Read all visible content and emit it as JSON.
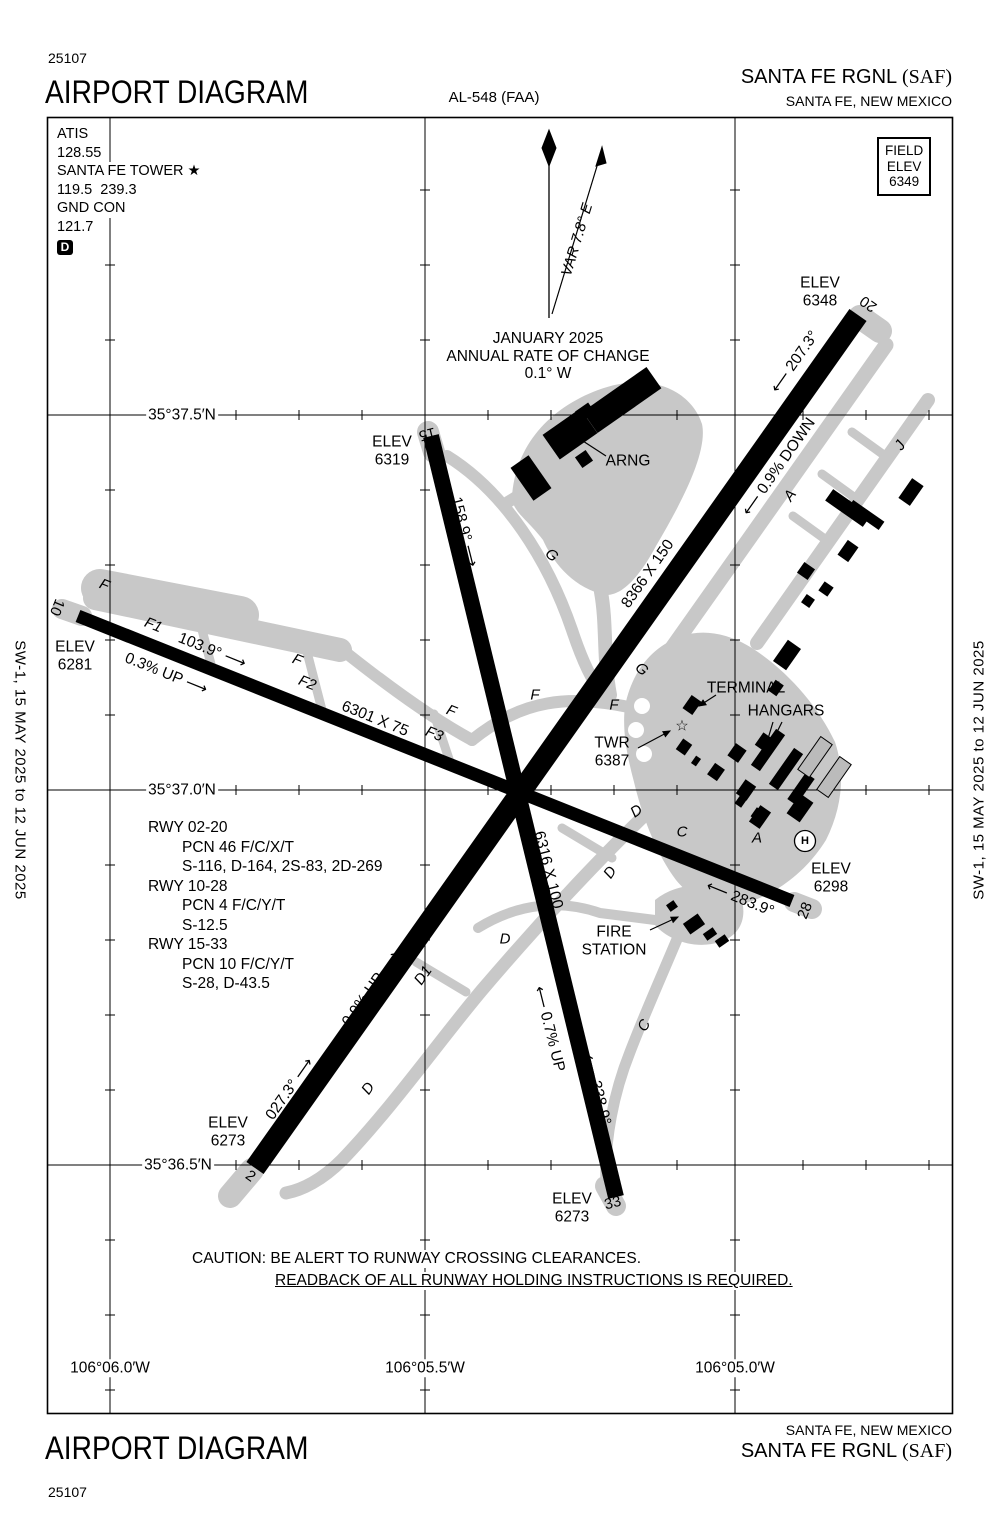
{
  "header": {
    "chart_number": "25107",
    "title": "AIRPORT DIAGRAM",
    "al_number": "AL-548 (FAA)",
    "airport_name": "SANTA FE RGNL ",
    "airport_code": "(SAF)",
    "city": "SANTA FE, NEW MEXICO"
  },
  "footer": {
    "title": "AIRPORT DIAGRAM",
    "chart_number": "25107",
    "city": "SANTA FE, NEW MEXICO",
    "airport_name": "SANTA FE RGNL ",
    "airport_code": "(SAF)"
  },
  "edge_note": "SW-1,  15 MAY 2025  to  12 JUN 2025",
  "comms": {
    "lines": [
      "ATIS",
      "128.55",
      "SANTA FE TOWER ★",
      "119.5  239.3",
      "GND CON",
      "121.7"
    ],
    "delivery_symbol": "D"
  },
  "field_elev": {
    "lines": [
      "FIELD",
      "ELEV",
      "6349"
    ]
  },
  "runways": [
    {
      "id": "02-20",
      "dimensions": "8366 X 150",
      "headings": "027.3° / 207.3°",
      "end_elevs": "6273 / 6348",
      "slope": "0.9%"
    },
    {
      "id": "10-28",
      "dimensions": "6301 X 75",
      "headings": "103.9° / 283.9°",
      "end_elevs": "6281 / 6298",
      "slope": "0.3%"
    },
    {
      "id": "15-33",
      "dimensions": "6316 X 100",
      "headings": "158.9° / 338.9°",
      "end_elevs": "6319 / 6273",
      "slope": "0.7%"
    }
  ],
  "rwy_data": {
    "lines": [
      {
        "t": "RWY 02-20",
        "ind": 0
      },
      {
        "t": "PCN 46 F/C/X/T",
        "ind": 1
      },
      {
        "t": "S-116, D-164, 2S-83, 2D-269",
        "ind": 1
      },
      {
        "t": "RWY 10-28",
        "ind": 0
      },
      {
        "t": "PCN 4 F/C/Y/T",
        "ind": 1
      },
      {
        "t": "S-12.5",
        "ind": 1
      },
      {
        "t": "RWY 15-33",
        "ind": 0
      },
      {
        "t": "PCN 10 F/C/Y/T",
        "ind": 1
      },
      {
        "t": "S-28, D-43.5",
        "ind": 1
      }
    ]
  },
  "caution": {
    "line1": "CAUTION: BE ALERT TO RUNWAY CROSSING CLEARANCES.",
    "line2": "READBACK OF ALL RUNWAY HOLDING INSTRUCTIONS IS REQUIRED."
  },
  "placed_labels": [
    {
      "n": "elev-rwy20",
      "t": "ELEV\n6348",
      "x": 820,
      "y": 292
    },
    {
      "n": "rwy20-number",
      "t": "20",
      "x": 869,
      "y": 303,
      "r": 215,
      "c": "num"
    },
    {
      "n": "hdg-207",
      "t": "⟵ 207.3°",
      "x": 795,
      "y": 362,
      "r": -55
    },
    {
      "n": "slope-09-down",
      "t": "⟵ 0.9% DOWN",
      "x": 779,
      "y": 467,
      "r": -55
    },
    {
      "n": "dim-rwy2-20",
      "t": "8366 X 150",
      "x": 648,
      "y": 574,
      "r": -55
    },
    {
      "n": "slope-09-up",
      "t": "0.9% UP ⟶",
      "x": 371,
      "y": 989,
      "r": -55
    },
    {
      "n": "hdg-027",
      "t": "027.3° ⟶",
      "x": 290,
      "y": 1089,
      "r": -55
    },
    {
      "n": "elev-rwy2",
      "t": "ELEV\n6273",
      "x": 228,
      "y": 1132
    },
    {
      "n": "rwy2-number",
      "t": "2",
      "x": 250,
      "y": 1177,
      "r": 35,
      "c": "num"
    },
    {
      "n": "elev-rwy15",
      "t": "ELEV\n6319",
      "x": 392,
      "y": 451
    },
    {
      "n": "rwy15-number",
      "t": "15",
      "x": 427,
      "y": 433,
      "r": 166,
      "c": "num"
    },
    {
      "n": "hdg-158",
      "t": "158.9° ⟶",
      "x": 464,
      "y": 532,
      "r": 76
    },
    {
      "n": "dim-rwy15-33",
      "t": "6316 X 100",
      "x": 548,
      "y": 870,
      "r": 76
    },
    {
      "n": "slope-07-up",
      "t": "⟵ 0.7% UP",
      "x": 549,
      "y": 1029,
      "r": 76
    },
    {
      "n": "hdg-338",
      "t": "⟵ 338.9°",
      "x": 597,
      "y": 1090,
      "r": 76
    },
    {
      "n": "elev-rwy33",
      "t": "ELEV\n6273",
      "x": 572,
      "y": 1208
    },
    {
      "n": "rwy33-number",
      "t": "33",
      "x": 613,
      "y": 1204,
      "r": -14,
      "c": "num"
    },
    {
      "n": "rwy10-number",
      "t": "10",
      "x": 56,
      "y": 607,
      "r": 112,
      "c": "num"
    },
    {
      "n": "elev-rwy10",
      "t": "ELEV\n6281",
      "x": 75,
      "y": 656
    },
    {
      "n": "hdg-103",
      "t": "103.9° ⟶",
      "x": 212,
      "y": 651,
      "r": 22
    },
    {
      "n": "slope-03-up",
      "t": "0.3% UP ⟶",
      "x": 166,
      "y": 674,
      "r": 22
    },
    {
      "n": "dim-rwy10-28",
      "t": "6301 X 75",
      "x": 375,
      "y": 719,
      "r": 22
    },
    {
      "n": "hdg-283",
      "t": "⟵ 283.9°",
      "x": 740,
      "y": 899,
      "r": 22
    },
    {
      "n": "rwy28-number",
      "t": "28",
      "x": 806,
      "y": 911,
      "r": -68,
      "c": "num"
    },
    {
      "n": "elev-rwy28",
      "t": "ELEV\n6298",
      "x": 831,
      "y": 878
    },
    {
      "n": "label-terminal",
      "t": "TERMINAL",
      "x": 746,
      "y": 688
    },
    {
      "n": "label-hangars",
      "t": "HANGARS",
      "x": 786,
      "y": 711
    },
    {
      "n": "label-twr",
      "t": "TWR\n6387",
      "x": 612,
      "y": 752
    },
    {
      "n": "label-arng",
      "t": "ARNG",
      "x": 628,
      "y": 461
    },
    {
      "n": "label-fire-station",
      "t": "FIRE\nSTATION",
      "x": 614,
      "y": 941
    },
    {
      "n": "tower-star-icon",
      "t": "☆",
      "x": 682,
      "y": 727,
      "c": "star"
    },
    {
      "n": "var-label",
      "t": "VAR 7.8° E",
      "x": 578,
      "y": 240,
      "r": -73,
      "c": "it"
    },
    {
      "n": "mag-var-note",
      "t": "JANUARY 2025\nANNUAL RATE OF CHANGE\n0.1° W",
      "x": 548,
      "y": 356
    },
    {
      "n": "lat-35-37-5n",
      "t": "35°37.5′N",
      "x": 182,
      "y": 415,
      "c": "halo"
    },
    {
      "n": "lat-35-37-0n",
      "t": "35°37.0′N",
      "x": 182,
      "y": 790,
      "c": "halo"
    },
    {
      "n": "lat-35-36-5n",
      "t": "35°36.5′N",
      "x": 178,
      "y": 1165,
      "c": "halo"
    },
    {
      "n": "lon-106-06-0w",
      "t": "106°06.0′W",
      "x": 110,
      "y": 1368,
      "c": "halo"
    },
    {
      "n": "lon-106-05-5w",
      "t": "106°05.5′W",
      "x": 425,
      "y": 1368,
      "c": "halo"
    },
    {
      "n": "lon-106-05-0w",
      "t": "106°05.0′W",
      "x": 735,
      "y": 1368,
      "c": "halo"
    },
    {
      "n": "helipad-h",
      "t": "H",
      "x": 805,
      "y": 841,
      "c": "hp"
    },
    {
      "n": "twy-f-a",
      "t": "F",
      "x": 104,
      "y": 586,
      "r": 22,
      "c": "it"
    },
    {
      "n": "twy-f1",
      "t": "F1",
      "x": 153,
      "y": 626,
      "r": 22,
      "c": "it"
    },
    {
      "n": "twy-f-b",
      "t": "F",
      "x": 297,
      "y": 661,
      "r": 22,
      "c": "it"
    },
    {
      "n": "twy-f2",
      "t": "F2",
      "x": 307,
      "y": 684,
      "r": 22,
      "c": "it"
    },
    {
      "n": "twy-f3",
      "t": "F3",
      "x": 434,
      "y": 735,
      "r": 22,
      "c": "it"
    },
    {
      "n": "twy-f-c",
      "t": "F",
      "x": 451,
      "y": 712,
      "r": 22,
      "c": "it"
    },
    {
      "n": "twy-f-d",
      "t": "F",
      "x": 535,
      "y": 696,
      "c": "it"
    },
    {
      "n": "twy-f-e",
      "t": "F",
      "x": 614,
      "y": 706,
      "c": "it"
    },
    {
      "n": "twy-g-a",
      "t": "G",
      "x": 551,
      "y": 556,
      "r": 40,
      "c": "it"
    },
    {
      "n": "twy-g-b",
      "t": "G",
      "x": 641,
      "y": 670,
      "r": 40,
      "c": "it"
    },
    {
      "n": "twy-a-a",
      "t": "A",
      "x": 791,
      "y": 496,
      "r": -55,
      "c": "it"
    },
    {
      "n": "twy-a-b",
      "t": "A",
      "x": 757,
      "y": 839,
      "c": "it"
    },
    {
      "n": "twy-j",
      "t": "J",
      "x": 901,
      "y": 446,
      "r": -55,
      "c": "it"
    },
    {
      "n": "twy-d-a",
      "t": "D",
      "x": 637,
      "y": 812,
      "r": -35,
      "c": "it"
    },
    {
      "n": "twy-d-b",
      "t": "D",
      "x": 611,
      "y": 873,
      "r": -55,
      "c": "it"
    },
    {
      "n": "twy-d-c",
      "t": "D",
      "x": 505,
      "y": 940,
      "c": "it"
    },
    {
      "n": "twy-d1",
      "t": "D1",
      "x": 424,
      "y": 976,
      "r": -55,
      "c": "it"
    },
    {
      "n": "twy-d-d",
      "t": "D",
      "x": 369,
      "y": 1089,
      "r": -55,
      "c": "it"
    },
    {
      "n": "twy-c-a",
      "t": "C",
      "x": 682,
      "y": 833,
      "c": "it"
    },
    {
      "n": "twy-c-b",
      "t": "C",
      "x": 645,
      "y": 1026,
      "r": -60,
      "c": "it"
    }
  ],
  "colors": {
    "taxiway_gray": "#c8c8c8",
    "runway_black": "#000000",
    "background": "#ffffff"
  }
}
